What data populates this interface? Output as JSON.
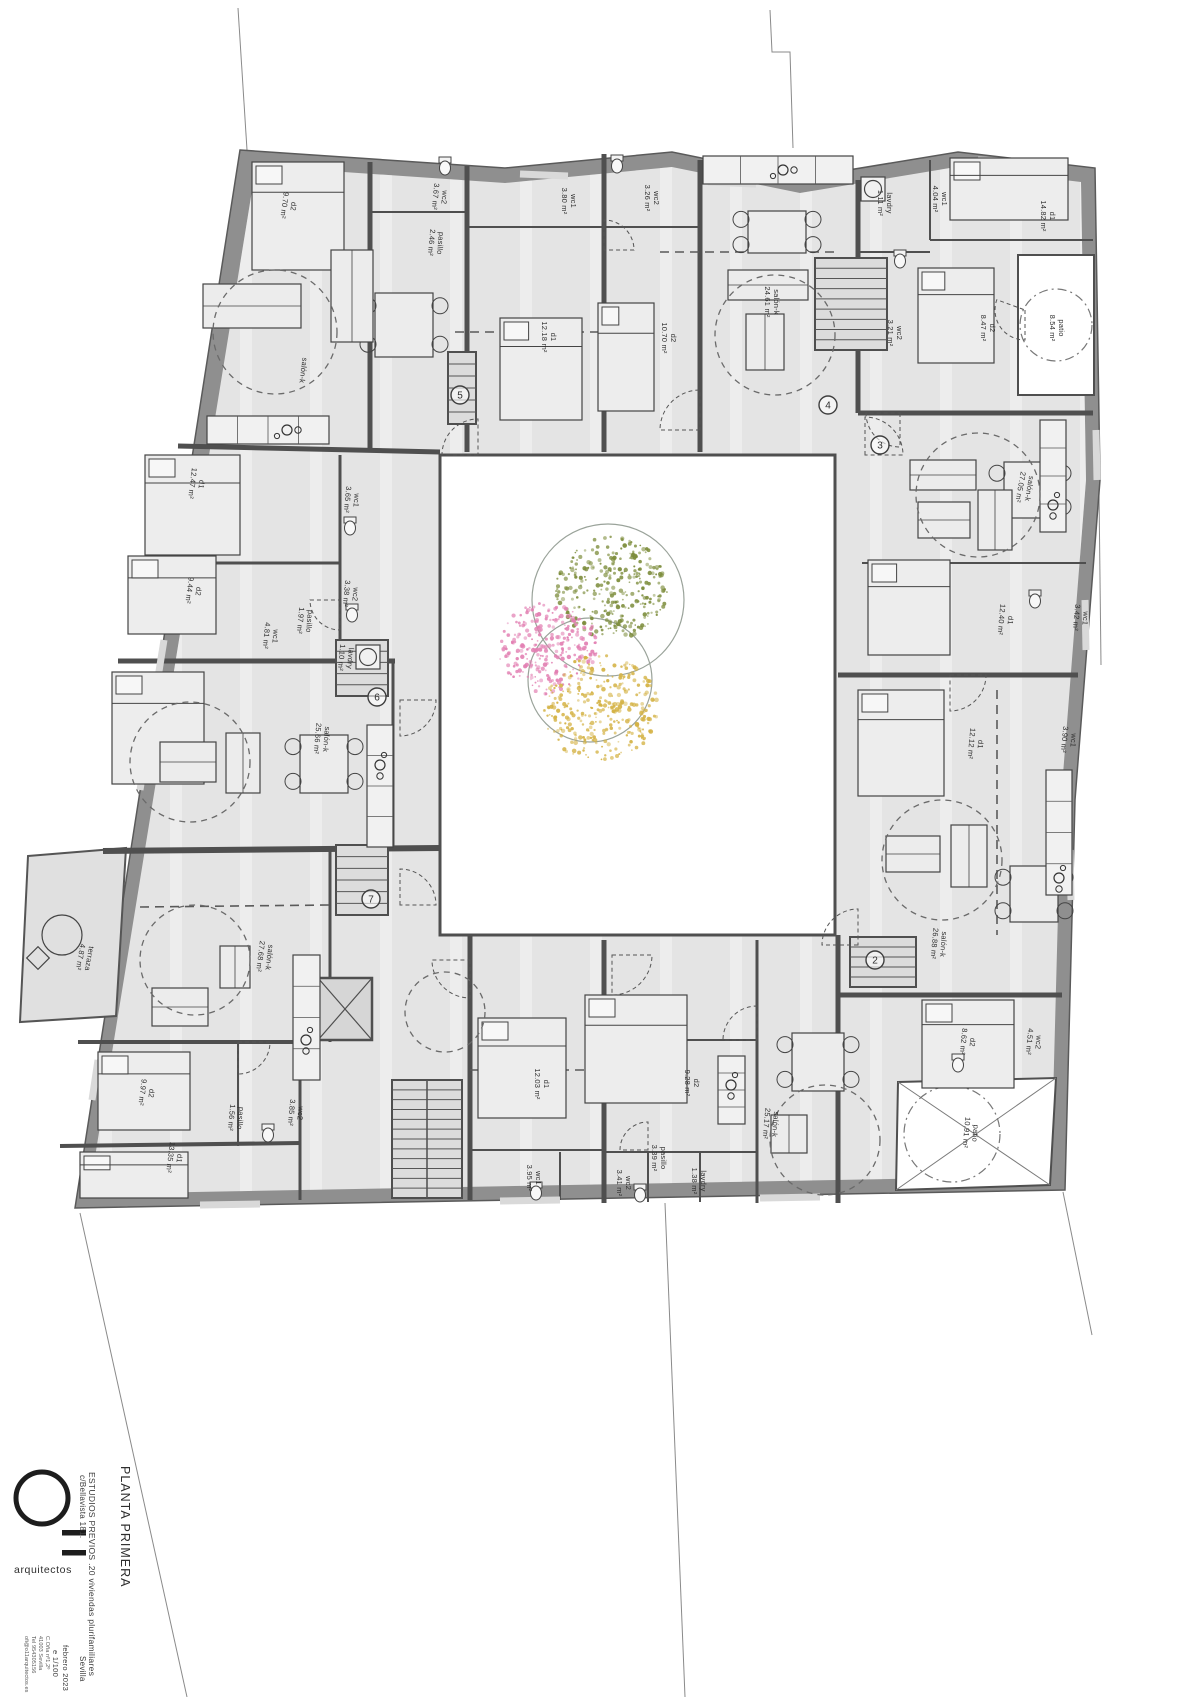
{
  "title_block": {
    "logo": {
      "mark": "O11",
      "sub": "arquitectos"
    },
    "drawing_title": "PLANTA PRIMERA",
    "project": "ESTUDIOS PREVIOS .20 viviendas plurifamiliares",
    "address": "c/Bellavista 181.",
    "city": "Sevilla",
    "date": "febrero 2023",
    "scale": "e 1/100",
    "office": [
      "C.Oña nº1,2º",
      "41003 Sevilla",
      "Tel 954305156",
      "ofi@o11arquitectos.es"
    ]
  },
  "plan": {
    "unit_numbers": [
      {
        "n": "5",
        "x": 460,
        "y": 395
      },
      {
        "n": "4",
        "x": 828,
        "y": 405
      },
      {
        "n": "3",
        "x": 880,
        "y": 445
      },
      {
        "n": "6",
        "x": 377,
        "y": 697
      },
      {
        "n": "7",
        "x": 371,
        "y": 899
      },
      {
        "n": "2",
        "x": 875,
        "y": 960
      }
    ],
    "rooms": [
      {
        "name": "d2",
        "area": "9.70 m²",
        "x": 290,
        "y": 206,
        "rot": 97
      },
      {
        "name": "wc2",
        "area": "3.67 m²",
        "x": 441,
        "y": 197,
        "rot": 95
      },
      {
        "name": "pasillo",
        "area": "2.46 m²",
        "x": 437,
        "y": 243,
        "rot": 95
      },
      {
        "name": "salón-k",
        "area": "",
        "x": 300,
        "y": 370,
        "rot": 97
      },
      {
        "name": "wc1",
        "area": "3.80 m²",
        "x": 570,
        "y": 201,
        "rot": 90
      },
      {
        "name": "d1",
        "area": "12.18 m²",
        "x": 550,
        "y": 337,
        "rot": 90
      },
      {
        "name": "wc2",
        "area": "3.26 m²",
        "x": 653,
        "y": 198,
        "rot": 90
      },
      {
        "name": "d2",
        "area": "10.70 m²",
        "x": 670,
        "y": 338,
        "rot": 90
      },
      {
        "name": "salón-k",
        "area": "24.61 m²",
        "x": 773,
        "y": 302,
        "rot": 90
      },
      {
        "name": "lavdry",
        "area": "1.11 m²",
        "x": 886,
        "y": 203,
        "rot": 90
      },
      {
        "name": "wc1",
        "area": "4.04 m²",
        "x": 941,
        "y": 199,
        "rot": 90
      },
      {
        "name": "d1",
        "area": "14.82 m²",
        "x": 1049,
        "y": 216,
        "rot": 90
      },
      {
        "name": "patio",
        "area": "8.54 m²",
        "x": 1058,
        "y": 328,
        "rot": 90
      },
      {
        "name": "wc2",
        "area": "3.21 m²",
        "x": 896,
        "y": 333,
        "rot": 90
      },
      {
        "name": "d2",
        "area": "8.47 m²",
        "x": 989,
        "y": 328,
        "rot": 90
      },
      {
        "name": "salón-k",
        "area": "27.05 m²",
        "x": 1026,
        "y": 488,
        "rot": 100
      },
      {
        "name": "d1",
        "area": "12.40 m²",
        "x": 1007,
        "y": 620,
        "rot": 95
      },
      {
        "name": "wc1",
        "area": "3.42 m²",
        "x": 1082,
        "y": 618,
        "rot": 95
      },
      {
        "name": "d1",
        "area": "12.12 m²",
        "x": 977,
        "y": 744,
        "rot": 95
      },
      {
        "name": "wc1",
        "area": "3.90 m²",
        "x": 1070,
        "y": 740,
        "rot": 95
      },
      {
        "name": "salón-k",
        "area": "26.88 m²",
        "x": 940,
        "y": 944,
        "rot": 95
      },
      {
        "name": "d2",
        "area": "8.62 m²",
        "x": 969,
        "y": 1042,
        "rot": 95
      },
      {
        "name": "wc2",
        "area": "4.51 m²",
        "x": 1035,
        "y": 1042,
        "rot": 95
      },
      {
        "name": "patio",
        "area": "10.91 m²",
        "x": 972,
        "y": 1133,
        "rot": 95
      },
      {
        "name": "d1",
        "area": "12.03 m²",
        "x": 543,
        "y": 1084,
        "rot": 90
      },
      {
        "name": "wc1",
        "area": "3.95 m²",
        "x": 535,
        "y": 1178,
        "rot": 90
      },
      {
        "name": "d2",
        "area": "9.28 m²",
        "x": 693,
        "y": 1083,
        "rot": 90
      },
      {
        "name": "pasillo",
        "area": "3.39 m²",
        "x": 660,
        "y": 1158,
        "rot": 90
      },
      {
        "name": "wc2",
        "area": "3.41 m²",
        "x": 625,
        "y": 1183,
        "rot": 90
      },
      {
        "name": "lavdry",
        "area": "1.38 m²",
        "x": 700,
        "y": 1181,
        "rot": 90
      },
      {
        "name": "salón-k",
        "area": "25.17 m²",
        "x": 772,
        "y": 1124,
        "rot": 95
      },
      {
        "name": "d1",
        "area": "12.47 m²",
        "x": 198,
        "y": 484,
        "rot": 97
      },
      {
        "name": "wc1",
        "area": "3.65 m²",
        "x": 353,
        "y": 500,
        "rot": 95
      },
      {
        "name": "d2",
        "area": "9.44 m²",
        "x": 195,
        "y": 591,
        "rot": 97
      },
      {
        "name": "wc2",
        "area": "3.38 m²",
        "x": 352,
        "y": 594,
        "rot": 95
      },
      {
        "name": "pasillo",
        "area": "1.97 m²",
        "x": 306,
        "y": 621,
        "rot": 95
      },
      {
        "name": "wc1",
        "area": "4.81 m²",
        "x": 272,
        "y": 636,
        "rot": 95
      },
      {
        "name": "lavdry",
        "area": "1.10 m²",
        "x": 347,
        "y": 658,
        "rot": 95
      },
      {
        "name": "salón-k",
        "area": "25.66 m²",
        "x": 323,
        "y": 739,
        "rot": 95
      },
      {
        "name": "salón-k",
        "area": "27.68 m²",
        "x": 266,
        "y": 957,
        "rot": 97
      },
      {
        "name": "terraza",
        "area": "4.87 m²",
        "x": 86,
        "y": 958,
        "rot": 100
      },
      {
        "name": "d2",
        "area": "9.97 m²",
        "x": 148,
        "y": 1093,
        "rot": 97
      },
      {
        "name": "pasillo",
        "area": "1.56 m²",
        "x": 237,
        "y": 1118,
        "rot": 95
      },
      {
        "name": "wc2",
        "area": "3.85 m²",
        "x": 297,
        "y": 1113,
        "rot": 95
      },
      {
        "name": "d1",
        "area": "13.35 m²",
        "x": 176,
        "y": 1158,
        "rot": 97
      }
    ],
    "trees": [
      {
        "color": "#7d8d3c",
        "cx": 612,
        "cy": 588,
        "r": 56,
        "n": 300
      },
      {
        "color": "#e27fb2",
        "cx": 548,
        "cy": 648,
        "r": 50,
        "n": 280
      },
      {
        "color": "#d4b244",
        "cx": 600,
        "cy": 708,
        "r": 58,
        "n": 320
      }
    ],
    "tree_outlines": [
      {
        "cx": 608,
        "cy": 600,
        "r": 76
      },
      {
        "cx": 590,
        "cy": 680,
        "r": 62
      }
    ],
    "colors": {
      "wall": "#8f8f8f",
      "wall_dark": "#4f4f4f",
      "floor": "#e4e4e4",
      "paper": "#ffffff",
      "label": "#2f2f2f"
    }
  }
}
